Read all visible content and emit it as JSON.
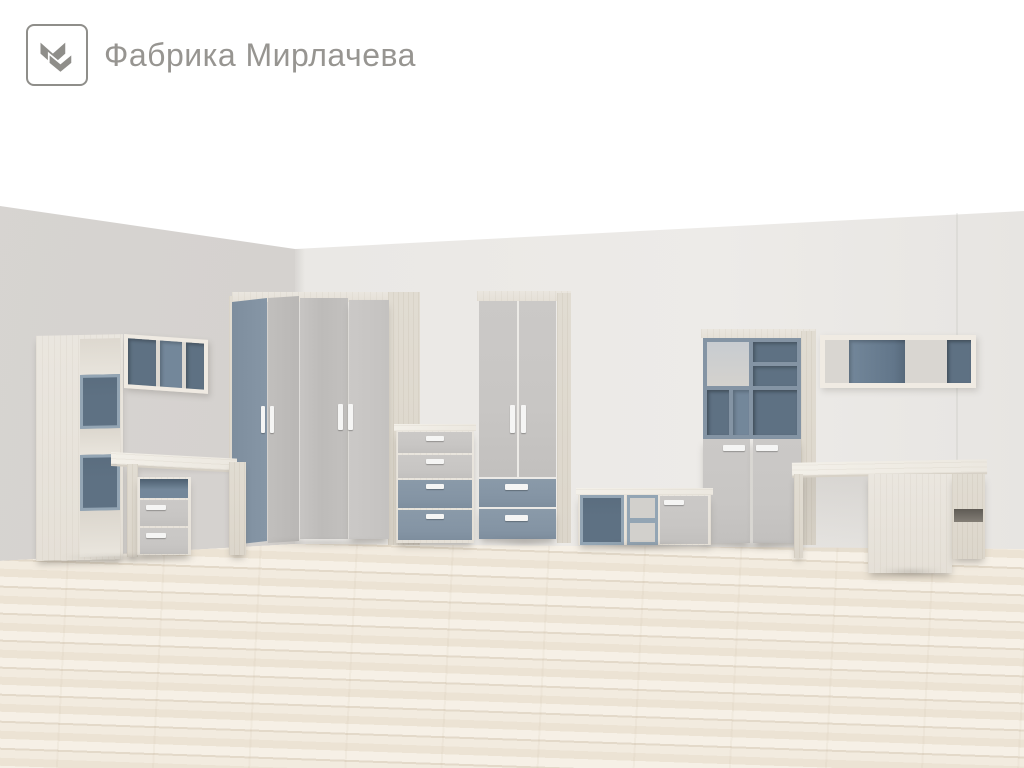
{
  "logo": {
    "text": "Фабрика Мирлачева",
    "mark": "double-chevron-m-icon"
  },
  "palette": {
    "background": "#ffffff",
    "wall_left": "#d7d4d1",
    "wall_back": "#e9e7e4",
    "floor_base": "#f1eadf",
    "floor_plank": "#e3d9c9",
    "wood": "#eae6df",
    "wood_bright": "#f3f0e9",
    "wood_side": "#e1dcd2",
    "gray": "#c8c6c4",
    "gray_dark": "#bcbab8",
    "blue": "#8494a4",
    "blue_deep": "#5e7183",
    "blue_medium": "#73879a",
    "blue_frame": "#93a5b4",
    "handle": "#f5f5f4",
    "logo_gray": "#8f8e8a",
    "text_gray": "#979591"
  },
  "scene": {
    "type": "3d-render-furniture-showroom",
    "items": [
      "tall-open-shelf",
      "wall-shelf-left",
      "desk-with-drawer-pedestal",
      "corner-wardrobe",
      "chest-of-drawers",
      "two-door-wardrobe-with-drawers",
      "storage-bench",
      "shelving-cabinet",
      "wall-shelf-right",
      "corner-desk"
    ]
  }
}
